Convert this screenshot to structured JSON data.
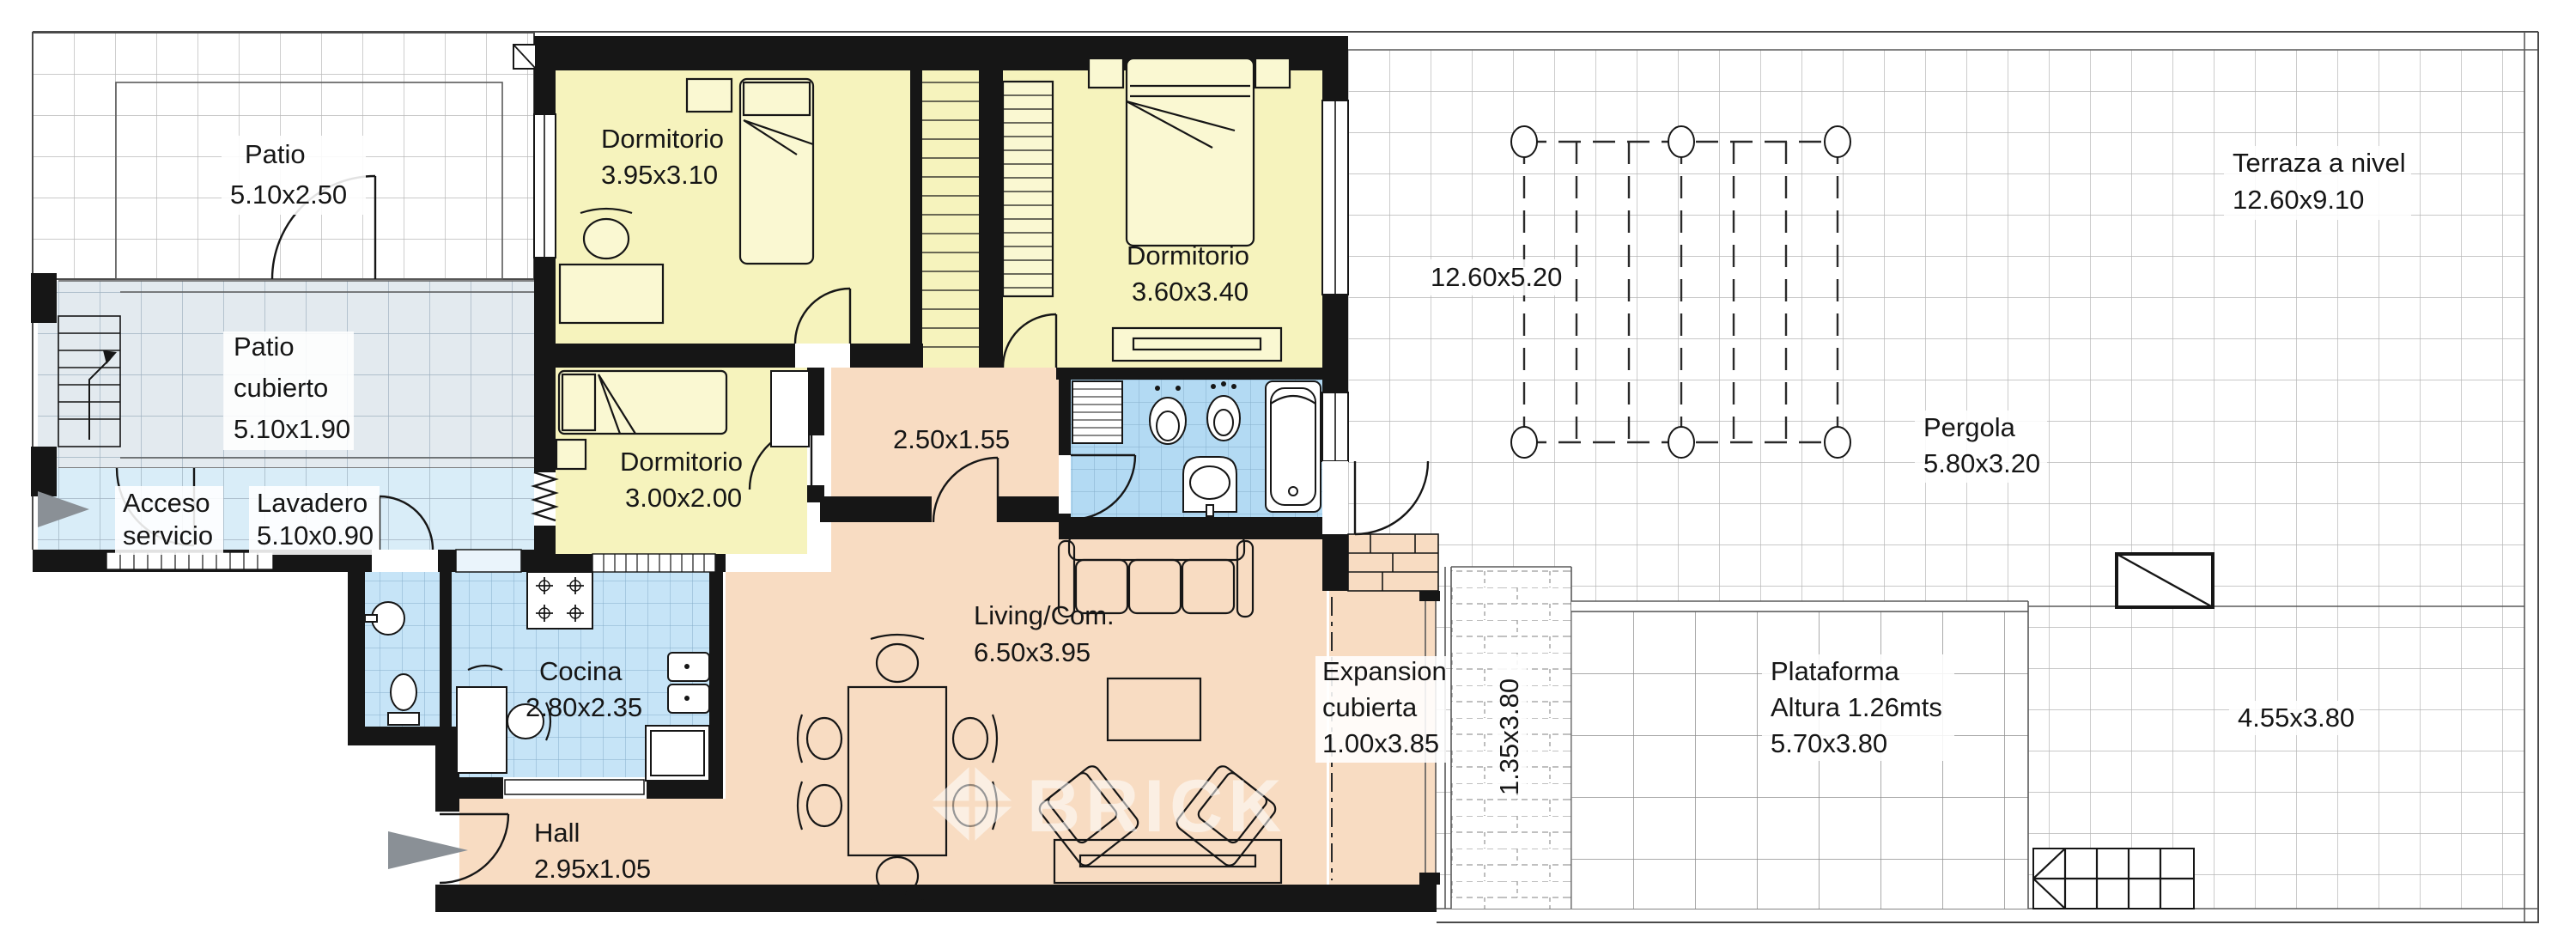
{
  "watermark": {
    "text": "BRICK"
  },
  "colors": {
    "bedroom": "#f6f3bd",
    "living": "#f8dcc2",
    "wet": "#c6e4f7",
    "bath": "#b3daf3",
    "patio_cubierto": "#e3eaef",
    "lavadero": "#d9edf8",
    "wall": "#161616",
    "grid": "#b6b6b6",
    "text": "#161616"
  },
  "rooms": {
    "patio": {
      "name": "Patio",
      "dims": "5.10x2.50"
    },
    "patio_cubierto": {
      "name": "Patio",
      "name2": "cubierto",
      "dims": "5.10x1.90"
    },
    "acceso": {
      "name": "Acceso",
      "name2": "servicio"
    },
    "lavadero": {
      "name": "Lavadero",
      "dims": "5.10x0.90"
    },
    "dormitorio1": {
      "name": "Dormitorio",
      "dims": "3.95x3.10"
    },
    "dormitorio2": {
      "name": "Dormitorio",
      "dims": "3.60x3.40"
    },
    "dormitorio3": {
      "name": "Dormitorio",
      "dims": "3.00x2.00"
    },
    "pasillo": {
      "dims": "2.50x1.55"
    },
    "cocina": {
      "name": "Cocina",
      "dims": "2.80x2.35"
    },
    "living": {
      "name": "Living/Com.",
      "dims": "6.50x3.95"
    },
    "hall": {
      "name": "Hall",
      "dims": "2.95x1.05"
    },
    "expansion": {
      "name": "Expansion",
      "name2": "cubierta",
      "dims": "1.00x3.85"
    },
    "pasaje": {
      "dims": "1.35x3.80"
    },
    "plataforma": {
      "name": "Plataforma",
      "name2": "Altura 1.26mts",
      "dims": "5.70x3.80"
    },
    "terraza": {
      "name": "Terraza a nivel",
      "dims": "12.60x9.10"
    },
    "terraza_pergola": {
      "dims": "12.60x5.20"
    },
    "terraza_lateral": {
      "dims": "4.55x3.80"
    },
    "pergola": {
      "name": "Pergola",
      "dims": "5.80x3.20"
    }
  }
}
